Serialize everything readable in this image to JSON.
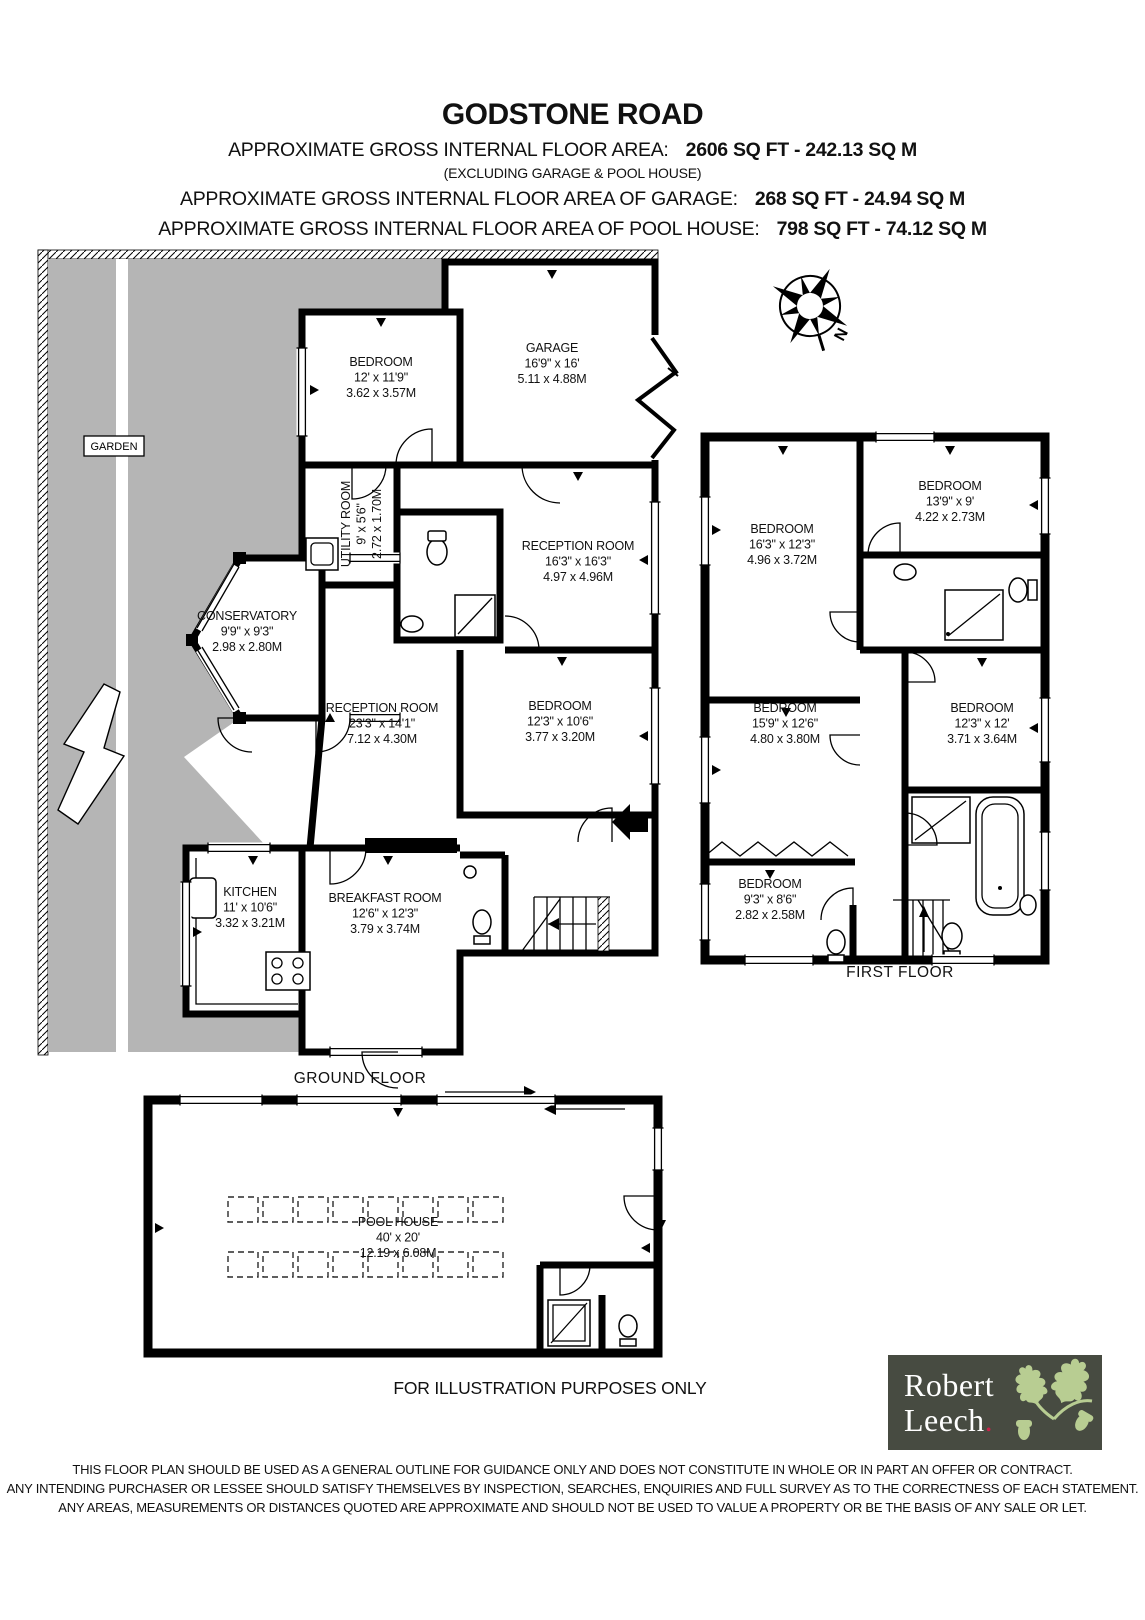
{
  "header": {
    "title": "GODSTONE ROAD",
    "area_label": "APPROXIMATE GROSS INTERNAL FLOOR AREA:",
    "area_value": "2606 SQ FT - 242.13 SQ M",
    "excluding": "(EXCLUDING GARAGE & POOL HOUSE)",
    "garage_label": "APPROXIMATE GROSS INTERNAL FLOOR AREA  OF GARAGE:",
    "garage_value": "268 SQ FT - 24.94 SQ M",
    "pool_label": "APPROXIMATE GROSS INTERNAL FLOOR AREA OF POOL HOUSE:",
    "pool_value": "798 SQ FT - 74.12 SQ M"
  },
  "garden_label": "GARDEN",
  "compass_label": "N",
  "floors": {
    "ground": {
      "label": "GROUND FLOOR",
      "rooms": [
        {
          "id": "bedroom-gf-1",
          "name": "BEDROOM",
          "imperial": "12' x 11'9\"",
          "metric": "3.62 x 3.57M"
        },
        {
          "id": "garage",
          "name": "GARAGE",
          "imperial": "16'9\" x 16'",
          "metric": "5.11 x 4.88M"
        },
        {
          "id": "utility-room",
          "name": "UTILITY ROOM",
          "imperial": "9' x 5'6\"",
          "metric": "2.72 x 1.70M"
        },
        {
          "id": "reception-room-1",
          "name": "RECEPTION ROOM",
          "imperial": "16'3\" x 16'3\"",
          "metric": "4.97 x 4.96M"
        },
        {
          "id": "conservatory",
          "name": "CONSERVATORY",
          "imperial": "9'9\" x 9'3\"",
          "metric": "2.98 x 2.80M"
        },
        {
          "id": "reception-room-2",
          "name": "RECEPTION ROOM",
          "imperial": "23'3\" x 14'1\"",
          "metric": "7.12 x 4.30M"
        },
        {
          "id": "bedroom-gf-2",
          "name": "BEDROOM",
          "imperial": "12'3\" x 10'6\"",
          "metric": "3.77 x 3.20M"
        },
        {
          "id": "kitchen",
          "name": "KITCHEN",
          "imperial": "11' x 10'6\"",
          "metric": "3.32 x 3.21M"
        },
        {
          "id": "breakfast-room",
          "name": "BREAKFAST ROOM",
          "imperial": "12'6\" x 12'3\"",
          "metric": "3.79 x 3.74M"
        }
      ]
    },
    "first": {
      "label": "FIRST FLOOR",
      "rooms": [
        {
          "id": "bedroom-ff-1",
          "name": "BEDROOM",
          "imperial": "16'3\" x 12'3\"",
          "metric": "4.96 x 3.72M"
        },
        {
          "id": "bedroom-ff-2",
          "name": "BEDROOM",
          "imperial": "13'9\" x 9'",
          "metric": "4.22 x 2.73M"
        },
        {
          "id": "bedroom-ff-3",
          "name": "BEDROOM",
          "imperial": "15'9\" x 12'6\"",
          "metric": "4.80 x 3.80M"
        },
        {
          "id": "bedroom-ff-4",
          "name": "BEDROOM",
          "imperial": "12'3\" x 12'",
          "metric": "3.71 x 3.64M"
        },
        {
          "id": "bedroom-ff-5",
          "name": "BEDROOM",
          "imperial": "9'3\" x 8'6\"",
          "metric": "2.82 x 2.58M"
        }
      ]
    },
    "pool": {
      "label": "POOL HOUSE",
      "rooms": [
        {
          "id": "pool-house",
          "name": "POOL HOUSE",
          "imperial": "40' x 20'",
          "metric": "12.19 x 6.08M"
        }
      ]
    }
  },
  "footer": {
    "illustration": "FOR ILLUSTRATION PURPOSES ONLY",
    "disclaimer": [
      "THIS FLOOR PLAN SHOULD BE USED AS A GENERAL OUTLINE FOR GUIDANCE ONLY AND DOES NOT CONSTITUTE IN WHOLE OR IN PART AN OFFER OR CONTRACT.",
      "ANY INTENDING PURCHASER OR LESSEE SHOULD SATISFY THEMSELVES BY INSPECTION, SEARCHES, ENQUIRIES AND FULL SURVEY AS TO THE CORRECTNESS OF EACH STATEMENT.",
      "ANY AREAS, MEASUREMENTS OR DISTANCES QUOTED ARE APPROXIMATE AND SHOULD NOT BE USED TO VALUE A PROPERTY OR BE THE BASIS OF ANY SALE OR LET."
    ]
  },
  "logo": {
    "line1": "Robert",
    "line2": "Leech",
    "dot": ".",
    "colors": {
      "background": "#474b41",
      "leaf": "#b8cd92",
      "dot": "#c8234a",
      "text": "#ffffff"
    }
  },
  "colors": {
    "garden": "#b5b5b5",
    "walls": "#000000"
  }
}
